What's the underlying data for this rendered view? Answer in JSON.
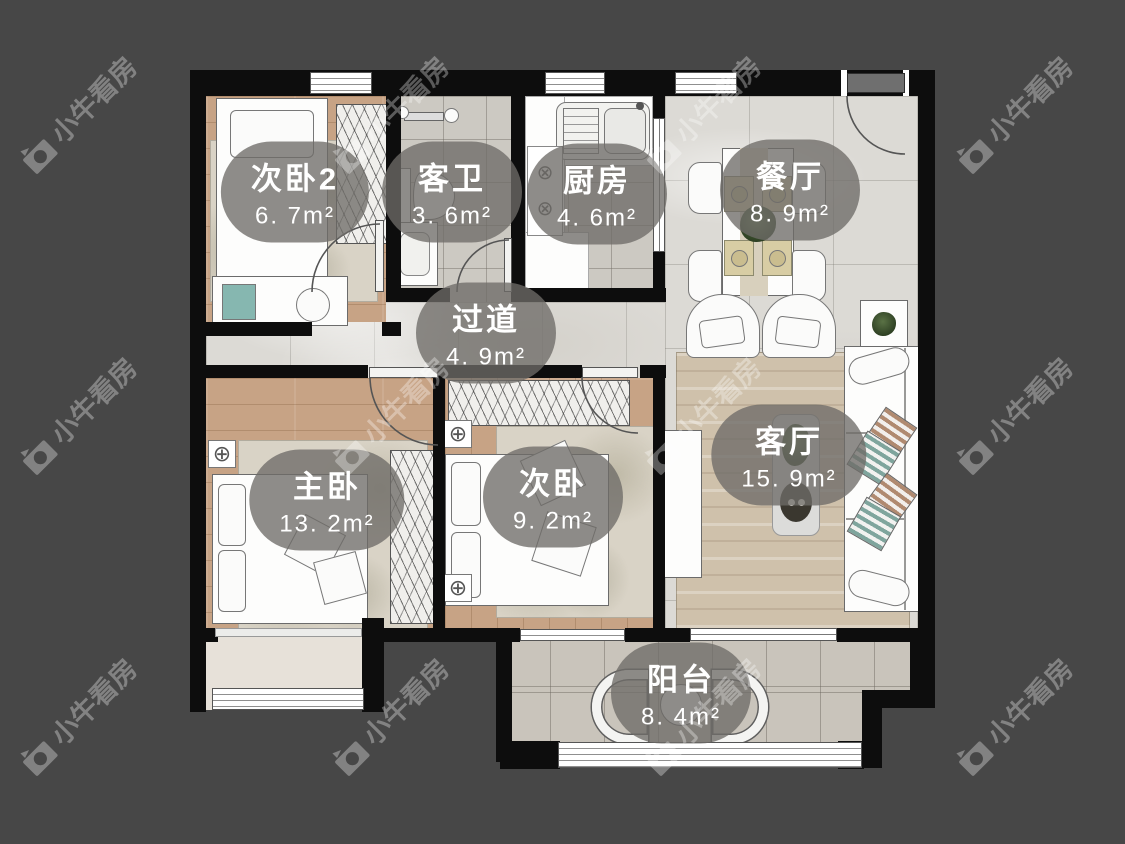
{
  "brand_watermark": {
    "text": "小牛看房",
    "icon": "camera-icon"
  },
  "rooms": [
    {
      "name": "次卧2",
      "area": "6. 7m²"
    },
    {
      "name": "客卫",
      "area": "3. 6m²"
    },
    {
      "name": "厨房",
      "area": "4. 6m²"
    },
    {
      "name": "餐厅",
      "area": "8. 9m²"
    },
    {
      "name": "过道",
      "area": "4. 9m²"
    },
    {
      "name": "主卧",
      "area": "13. 2m²"
    },
    {
      "name": "次卧",
      "area": "9. 2m²"
    },
    {
      "name": "客厅",
      "area": "15. 9m²"
    },
    {
      "name": "阳台",
      "area": "8. 4m²"
    }
  ],
  "icons": {
    "ceiling_light": "⊕",
    "stove_burner": "⊗"
  },
  "colors": {
    "background": "#474747",
    "wall": "#0d0d0d",
    "wood_floor": "#c7a385",
    "tile_floor": "#ccc9c2",
    "marble_floor": "#dcdad5",
    "balcony_floor": "#c9c4bb",
    "label_pill": "rgba(110,108,104,0.78)",
    "label_text": "#ffffff",
    "watermark": "rgba(255,255,255,0.32)"
  }
}
